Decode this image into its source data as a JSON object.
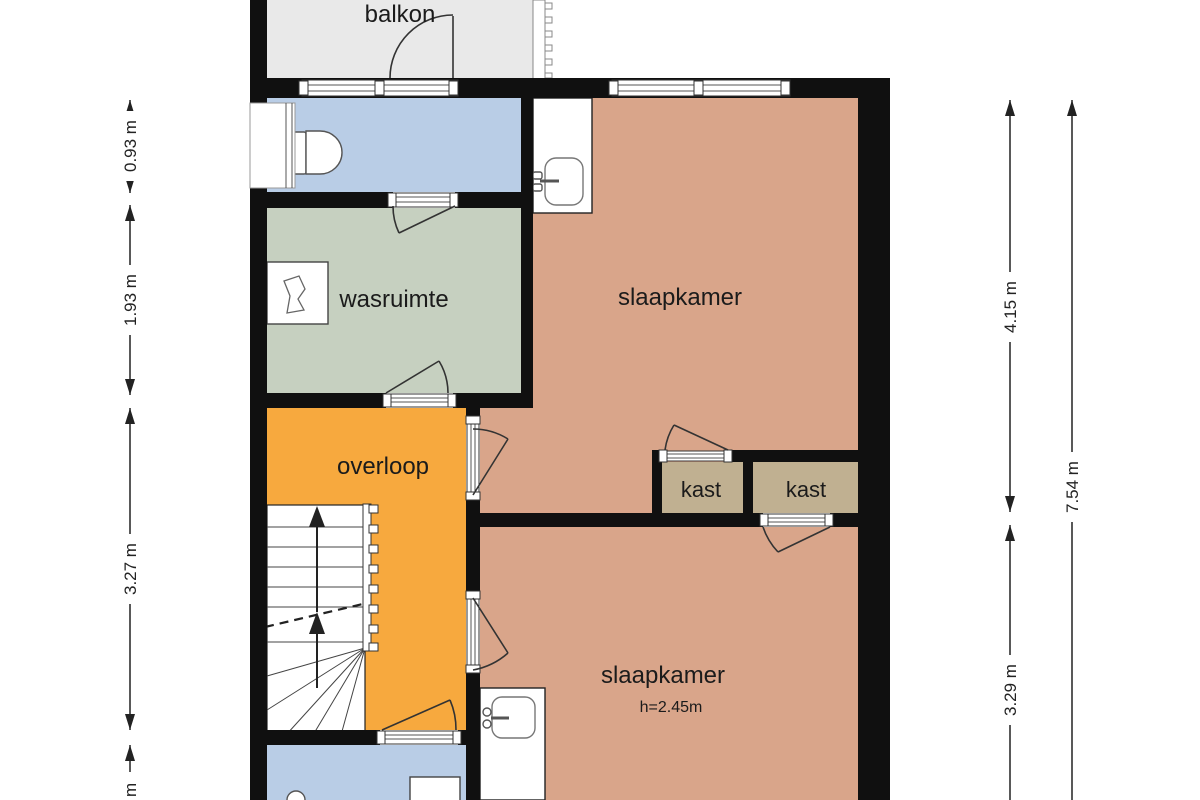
{
  "title": "verdieping plattegrond",
  "rooms": {
    "balkon": "balkon",
    "wasruimte": "wasruimte",
    "slaapkamer_boven": "slaapkamer",
    "overloop": "overloop",
    "kast_links": "kast",
    "kast_rechts": "kast",
    "slaapkamer_onder": "slaapkamer",
    "slaapkamer_onder_hoogte": "h=2.45m"
  },
  "dimensions": {
    "left": [
      {
        "label": "0.93 m"
      },
      {
        "label": "1.93 m"
      },
      {
        "label": "3.27 m"
      },
      {
        "label": "1 m"
      }
    ],
    "right": [
      {
        "label": "4.15 m"
      },
      {
        "label": "3.29 m"
      },
      {
        "label": "7.54 m"
      }
    ]
  },
  "icons": {
    "toilet": "toilet-icon",
    "washing_machine": "washing-machine-icon",
    "washbasin_top": "washbasin-icon",
    "washbasin_bottom": "washbasin-icon",
    "stairs": "stairs-up-arrows"
  },
  "colors": {
    "wall": "#101010",
    "balkon": "#e9e9e9",
    "badkamer": "#b9cde6",
    "wasruimte": "#c6d0c0",
    "slaapkamer": "#d9a58a",
    "overloop": "#f7a93e",
    "kast": "#c0b091"
  }
}
